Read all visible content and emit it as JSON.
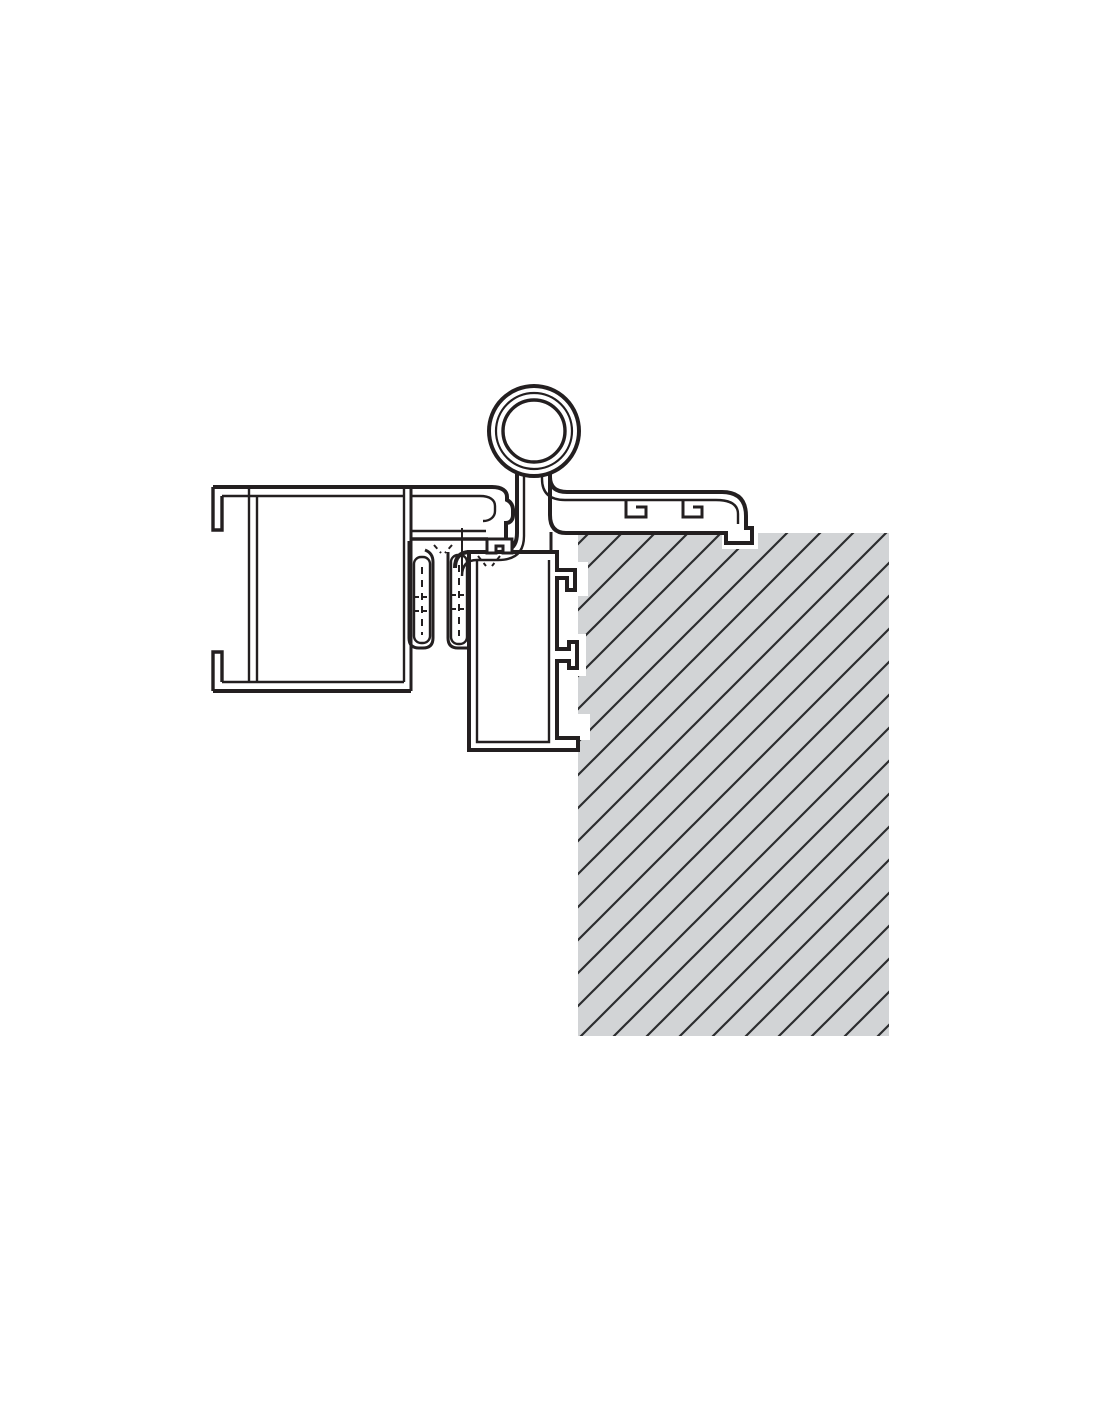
{
  "canvas": {
    "width": 1100,
    "height": 1422
  },
  "colors": {
    "background": "#ffffff",
    "line": "#231f20",
    "wall_fill": "#d2d4d6",
    "hatch_line": "#2c2d2f"
  },
  "wall": {
    "x": 578,
    "y": 533,
    "width": 311,
    "height": 503
  },
  "hatch": {
    "tile": 33,
    "stroke_width": 2.2,
    "path": "M -8.25,8.25 L 8.25,-8.25 M -8.25,41.25 L 41.25,-8.25 M 24.75,41.25 L 41.25,24.75"
  },
  "pads": {
    "upper_anchor": {
      "x": 566,
      "y": 562,
      "width": 22,
      "height": 34
    },
    "middle_anchor": {
      "x": 564,
      "y": 634,
      "width": 22,
      "height": 42
    },
    "foot_notch": {
      "x": 574,
      "y": 714,
      "width": 16,
      "height": 26
    },
    "cover_hook": {
      "x": 722,
      "y": 533,
      "width": 36,
      "height": 16
    }
  },
  "hinge_knuckle": {
    "cx": 534,
    "cy": 431,
    "r_outer": 45,
    "r_middle": 38,
    "r_inner": 31
  },
  "paths": {
    "jamb_body": "M 469,552 L 469,750 L 578,750 L 578,738 L 557,738 L 557,661 L 569,661 L 569,668 L 577,668 L 577,642 L 569,642 L 569,649 L 557,649 L 557,578 L 567,578 L 567,590 L 575,590 L 575,570 L 557,570 L 557,552 Z",
    "jamb_inner": "M 477,560 L 477,742 L 549,742 L 549,560",
    "frame_left_outer": "M 455,568 Q 455,552 470,552 L 498,552 Q 517,552 517,533 L 517,470",
    "frame_left_inner": "M 462,576 Q 462,560 477,560 L 498,560 Q 524,560 524,536 L 524,472",
    "frame_connector": "M 551,532 L 551,553",
    "cover_body": "M 550,470 L 550,477 Q 550,492 567,492 L 722,492 Q 746,492 746,516 L 746,528 L 752,528 L 752,543 L 726,543 L 726,533 L 566,533 Q 550,533 550,515 Z",
    "cover_inner": "M 542,470 L 542,479 Q 542,500 565,500 L 716,500 Q 738,500 738,514 L 738,524",
    "cover_tab_1": "M 626,500 L 626,517 L 646,517 L 646,507 L 636,507",
    "cover_tab_2": "M 683,500 L 683,517 L 702,517 L 702,507 L 693,507",
    "leaf_top_nose": "M 213,487 L 492,487 C 502,487 507,491 507,497 L 507,500 C 511,502 513,506 513,510 L 513,515 C 513,520 510,523 506,523 L 506,539",
    "leaf_hook_top": "M 222,496 L 222,530 L 213,530 L 213,487",
    "leaf_hook_bottom": "M 222,682 L 222,652 L 213,652 L 213,691",
    "leaf_inner_top": "M 222,496 L 403,496",
    "leaf_wall_left_a": "M 249,487 L 249,682",
    "leaf_wall_left_b": "M 257,496 L 257,682",
    "leaf_divider_a": "M 404,487 L 404,682",
    "leaf_divider_b": "M 411,487 L 411,691",
    "leaf_bottom_outer": "M 213,691 L 411,691",
    "leaf_bottom_inner": "M 222,682 L 404,682",
    "leaf_nose_inner": "M 412,496 L 480,496 C 490,496 495,500 495,506 L 495,511 C 495,517 490,521 483,521",
    "leaf_nose_bottom_a": "M 412,531 L 486,531",
    "leaf_nose_bottom_b": "M 410,539 L 488,539",
    "leaf_latch_tab": "M 487,539 L 512,539 L 512,553 L 503,553 L 503,546 L 496,546 L 496,553 L 487,553 Z",
    "gasket_channel_a": "M 409,541 L 409,638 Q 409,648 419,648 L 423,648 Q 433,648 433,638 L 433,562 Q 433,553 425,550",
    "gasket_channel_b": "M 448,552 L 448,638 Q 448,648 458,648 L 469,648",
    "gasket_dash_a": "M 422,567 L 422,635",
    "gasket_cross_a1": "M 415,597 L 429,597",
    "gasket_cross_a2": "M 415,611 L 429,611",
    "gasket_dash_b": "M 459,565 L 459,636",
    "gasket_cross_b1": "M 452,595 L 466,595",
    "gasket_cross_b2": "M 452,609 L 466,609",
    "gasket_ticks": "M 434,545 L 441,553 M 452,545 L 445,553 M 478,556 L 486,566 M 500,556 L 492,566",
    "gasket_stem": "M 462,528 L 462,576"
  },
  "gasket_lobes": {
    "a": {
      "x": 414,
      "y": 557,
      "width": 16,
      "height": 86,
      "rx": 7
    },
    "b": {
      "x": 451,
      "y": 555,
      "width": 16,
      "height": 89,
      "rx": 7
    }
  }
}
